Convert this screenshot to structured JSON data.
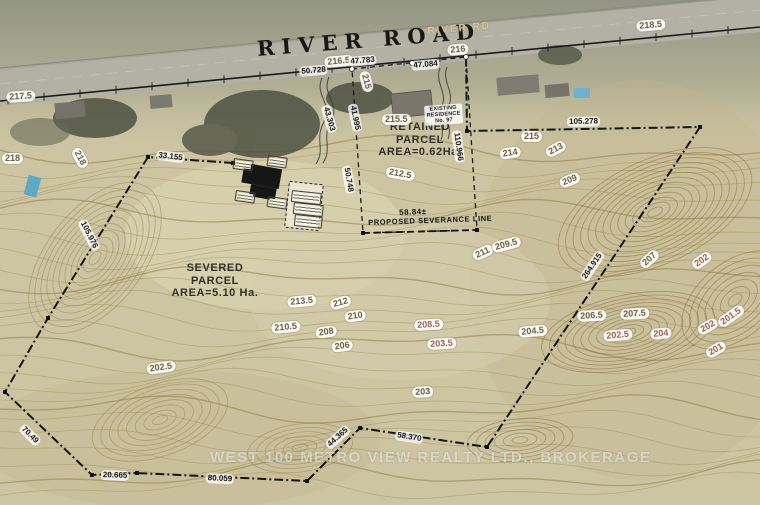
{
  "road": {
    "name": "RIVER ROAD",
    "sign": "RIVER RD"
  },
  "parcels": {
    "retained": {
      "line1": "RETAINED",
      "line2": "PARCEL",
      "line3": "AREA=0.62Ha."
    },
    "severed": {
      "line1": "SEVERED",
      "line2": "PARCEL",
      "line3": "AREA=5.10 Ha."
    }
  },
  "severance": {
    "dimension": "58.84±",
    "label": "PROPOSED SEVERANCE LINE"
  },
  "residence": {
    "line1": "EXISTING",
    "line2": "RESIDENCE",
    "line3": "No. 97"
  },
  "watermark": "WEST 100 METRO VIEW REALTY LTD., BROKERAGE",
  "contour_labels": [
    {
      "t": "217.5",
      "x": 6,
      "y": 92,
      "r": -4
    },
    {
      "t": "218",
      "x": 2,
      "y": 153,
      "r": 0
    },
    {
      "t": "218",
      "x": 80,
      "y": 146,
      "r": 62
    },
    {
      "t": "216.5",
      "x": 324,
      "y": 57,
      "r": -5
    },
    {
      "t": "216",
      "x": 447,
      "y": 45,
      "r": -5
    },
    {
      "t": "218.5",
      "x": 636,
      "y": 21,
      "r": -5
    },
    {
      "t": "215",
      "x": 369,
      "y": 70,
      "r": 75
    },
    {
      "t": "215.5",
      "x": 382,
      "y": 114,
      "r": 0
    },
    {
      "t": "215",
      "x": 521,
      "y": 131,
      "r": 0
    },
    {
      "t": "214",
      "x": 499,
      "y": 149,
      "r": -8
    },
    {
      "t": "213",
      "x": 544,
      "y": 149,
      "r": -28
    },
    {
      "t": "212.5",
      "x": 387,
      "y": 166,
      "r": 10
    },
    {
      "t": "209",
      "x": 558,
      "y": 179,
      "r": -22
    },
    {
      "t": "211",
      "x": 471,
      "y": 252,
      "r": -25
    },
    {
      "t": "209.5",
      "x": 491,
      "y": 243,
      "r": -15
    },
    {
      "t": "207",
      "x": 638,
      "y": 262,
      "r": -42
    },
    {
      "t": "202",
      "x": 690,
      "y": 262,
      "r": -35,
      "p": true
    },
    {
      "t": "213.5",
      "x": 287,
      "y": 297,
      "r": -5
    },
    {
      "t": "212",
      "x": 329,
      "y": 300,
      "r": -15
    },
    {
      "t": "210",
      "x": 344,
      "y": 312,
      "r": -8
    },
    {
      "t": "210.5",
      "x": 271,
      "y": 323,
      "r": -5
    },
    {
      "t": "208",
      "x": 315,
      "y": 328,
      "r": -8
    },
    {
      "t": "206",
      "x": 331,
      "y": 342,
      "r": -8
    },
    {
      "t": "208.5",
      "x": 414,
      "y": 320,
      "r": -3,
      "p": true
    },
    {
      "t": "203.5",
      "x": 427,
      "y": 339,
      "r": -3,
      "p": true
    },
    {
      "t": "206.5",
      "x": 577,
      "y": 311,
      "r": -3
    },
    {
      "t": "207.5",
      "x": 620,
      "y": 309,
      "r": -3
    },
    {
      "t": "204.5",
      "x": 518,
      "y": 327,
      "r": -5
    },
    {
      "t": "202.5",
      "x": 603,
      "y": 331,
      "r": -5,
      "p": true
    },
    {
      "t": "204",
      "x": 650,
      "y": 329,
      "r": -5,
      "p": true
    },
    {
      "t": "202",
      "x": 696,
      "y": 327,
      "r": -30,
      "p": true
    },
    {
      "t": "201.5",
      "x": 716,
      "y": 320,
      "r": -35,
      "p": true
    },
    {
      "t": "201",
      "x": 704,
      "y": 350,
      "r": -30,
      "p": true
    },
    {
      "t": "202.5",
      "x": 146,
      "y": 364,
      "r": -8
    },
    {
      "t": "203",
      "x": 412,
      "y": 387,
      "r": -3
    }
  ],
  "dimension_labels": [
    {
      "t": "50.728",
      "x": 299,
      "y": 67,
      "r": -5
    },
    {
      "t": "47.783",
      "x": 348,
      "y": 57,
      "r": -5
    },
    {
      "t": "47.084",
      "x": 411,
      "y": 61,
      "r": -5
    },
    {
      "t": "33.155",
      "x": 157,
      "y": 150,
      "r": 7
    },
    {
      "t": "105.976",
      "x": 86,
      "y": 218,
      "r": 63
    },
    {
      "t": "43.303",
      "x": 330,
      "y": 104,
      "r": 74
    },
    {
      "t": "41.995",
      "x": 357,
      "y": 103,
      "r": 78
    },
    {
      "t": "50.748",
      "x": 351,
      "y": 165,
      "r": 80
    },
    {
      "t": "110.966",
      "x": 461,
      "y": 130,
      "r": 82
    },
    {
      "t": "105.278",
      "x": 567,
      "y": 117,
      "r": -1
    },
    {
      "t": "264.915",
      "x": 579,
      "y": 277,
      "r": -56
    },
    {
      "t": "58.370",
      "x": 396,
      "y": 430,
      "r": 9
    },
    {
      "t": "44.365",
      "x": 324,
      "y": 443,
      "r": -42
    },
    {
      "t": "20.665",
      "x": 101,
      "y": 470,
      "r": 2
    },
    {
      "t": "80.059",
      "x": 206,
      "y": 473,
      "r": 3
    },
    {
      "t": "70.49",
      "x": 25,
      "y": 423,
      "r": 45
    }
  ],
  "colors": {
    "paper": "#cdc5a2",
    "contour": "#a39557",
    "contour_index": "#8f7f46",
    "contour_hill": "#8a6a35",
    "boundary": "#151515",
    "pool": "#5fa8c6",
    "photo": "#8e9282",
    "road_fill": "#b3b0a4"
  }
}
